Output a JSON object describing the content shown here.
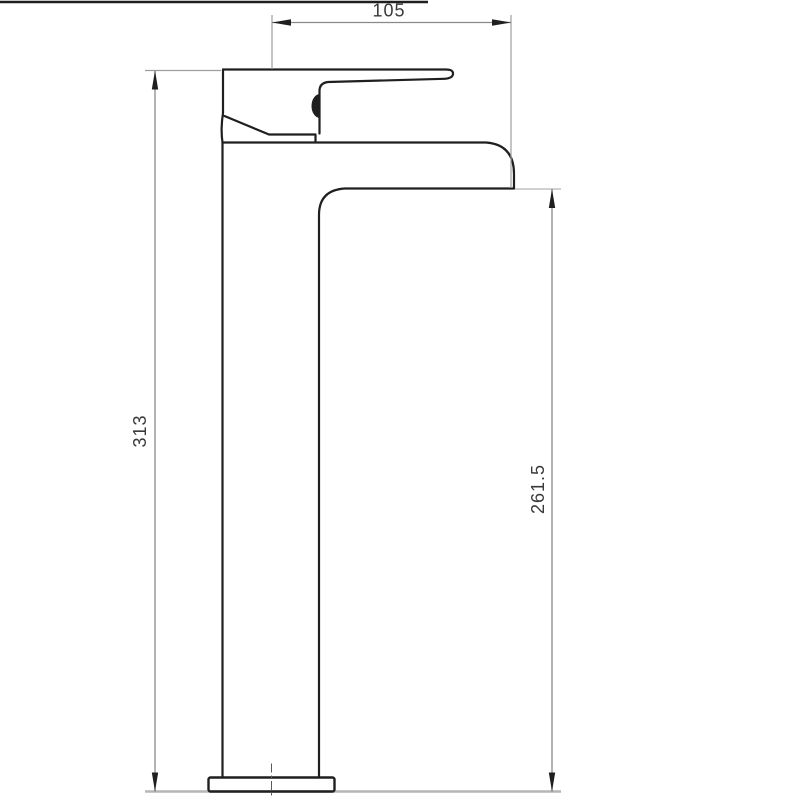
{
  "drawing": {
    "type": "technical-dimension-drawing",
    "subject": "tall-single-lever-basin-mixer-tap-side-elevation",
    "dimensions": {
      "top": "105",
      "left": "313",
      "right": "261.5"
    },
    "colors": {
      "background": "#ffffff",
      "outline": "#1f1f1f",
      "dimension_line": "#8a8a8a",
      "extension_line": "#9e9e9e",
      "ground_line": "#b5b5b5",
      "centerline": "#5a5a5a",
      "text": "#3a3a3a"
    }
  }
}
